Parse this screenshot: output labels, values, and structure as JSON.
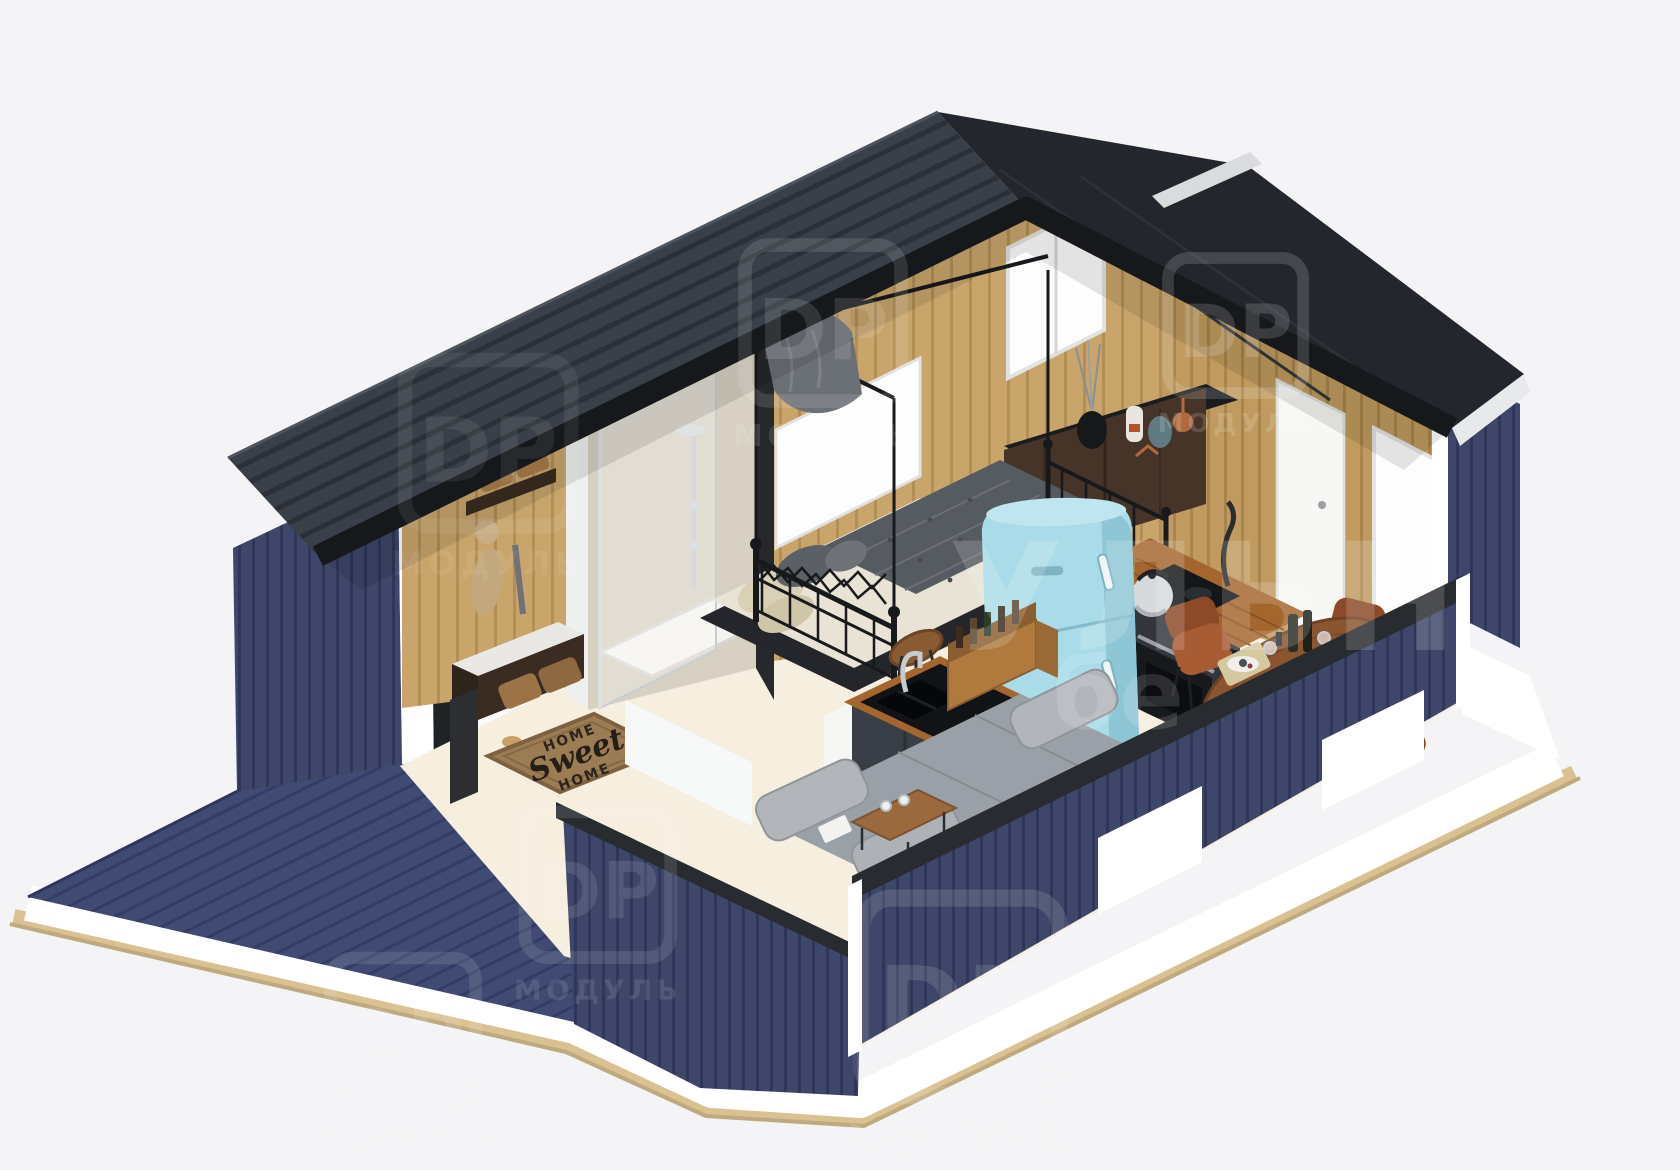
{
  "scene": {
    "type": "3d-isometric-cutaway-render",
    "subject": "tiny modular house with open floor plan, roof and front walls sectioned away",
    "background_color": "#f4f4f6",
    "rooms": [
      "deck-terrace",
      "entry-hall",
      "shower-room",
      "bedroom",
      "kitchen",
      "living-area",
      "dining-area"
    ],
    "furnishings": [
      "metal-frame-bed",
      "dresser-with-vases",
      "retro-fridge",
      "kitchen-counter-oven-kettle",
      "island-with-sink-and-wine-crate",
      "corner-sofa",
      "coffee-table",
      "round-dining-table",
      "leather-chairs",
      "shoe-bench",
      "coat-rack",
      "shower-column",
      "doormat"
    ]
  },
  "palette": {
    "roof": "#394049",
    "roof_edge": "#16181c",
    "siding_navy": "#3e4669",
    "deck_navy": "#404a72",
    "cut_trim_white": "#ffffff",
    "foundation_tan": "#d9c191",
    "wood_wall": "#c9a56b",
    "floor_cream": "#f6eede",
    "cabinet_charcoal": "#32363c",
    "counter_wood": "#a5662e",
    "fridge_blue": "#a9dce8",
    "sofa_gray": "#9aa0a7",
    "chair_leather": "#a85c34",
    "table_wood": "#8a5530",
    "doormat_brown": "#9c7c55",
    "bed_blanket_gray": "#565a61",
    "shower_stone": "#d7d0c3"
  },
  "doormat": {
    "word_top": "HOME",
    "word_middle": "Sweet",
    "word_bottom": "HOME"
  },
  "watermark": {
    "logo": "DP",
    "logo_caption": "МОДУЛЬ",
    "fragment_large": "УЛЬН",
    "fragment_small": "бе"
  }
}
